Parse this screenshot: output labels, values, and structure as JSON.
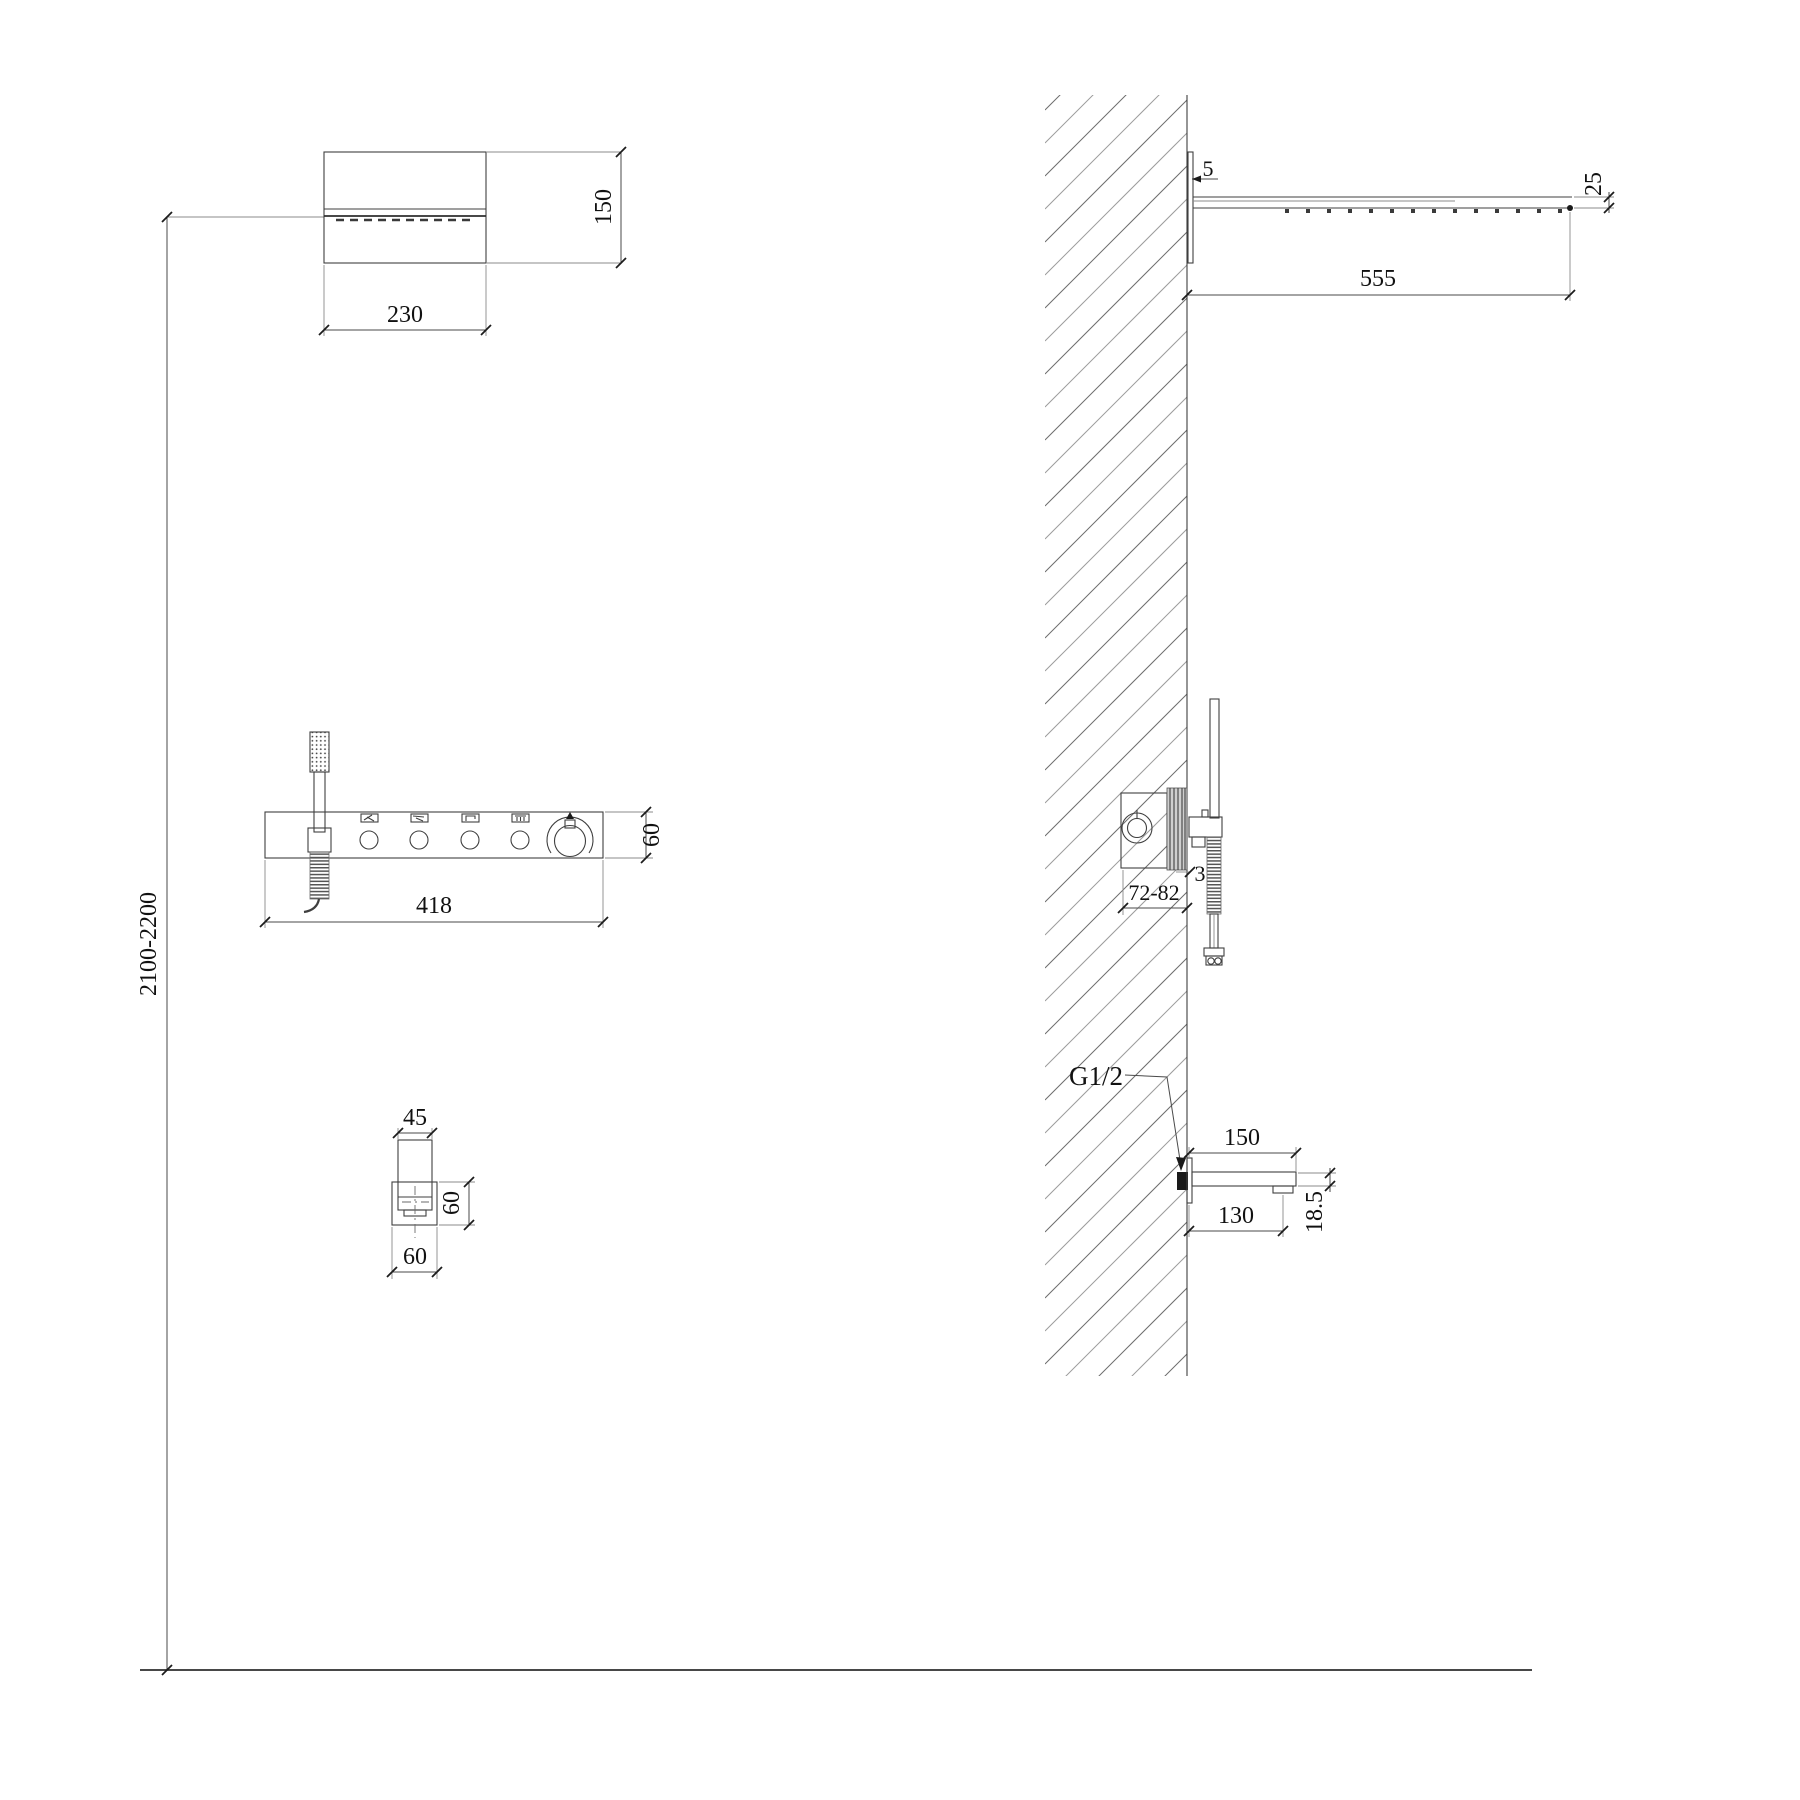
{
  "drawing_type": "shower-system-installation-drawing",
  "dims": {
    "head_width": "230",
    "head_height": "150",
    "install_height": "2100-2200",
    "panel_width": "418",
    "panel_height": "60",
    "head_plate": "5",
    "head_length": "555",
    "head_tip": "25",
    "valve_depth": "72-82",
    "valve_plate": "3",
    "spout_front_width": "45",
    "spout_front_height": "60",
    "spout_front_depth": "60",
    "thread": "G1/2",
    "spout_top": "150",
    "spout_bottom": "130",
    "spout_tip": "18.5"
  },
  "icons": {
    "panel_modes": [
      "hand-shower",
      "waterfall",
      "spout",
      "rain"
    ],
    "knob": "temperature-knob"
  }
}
